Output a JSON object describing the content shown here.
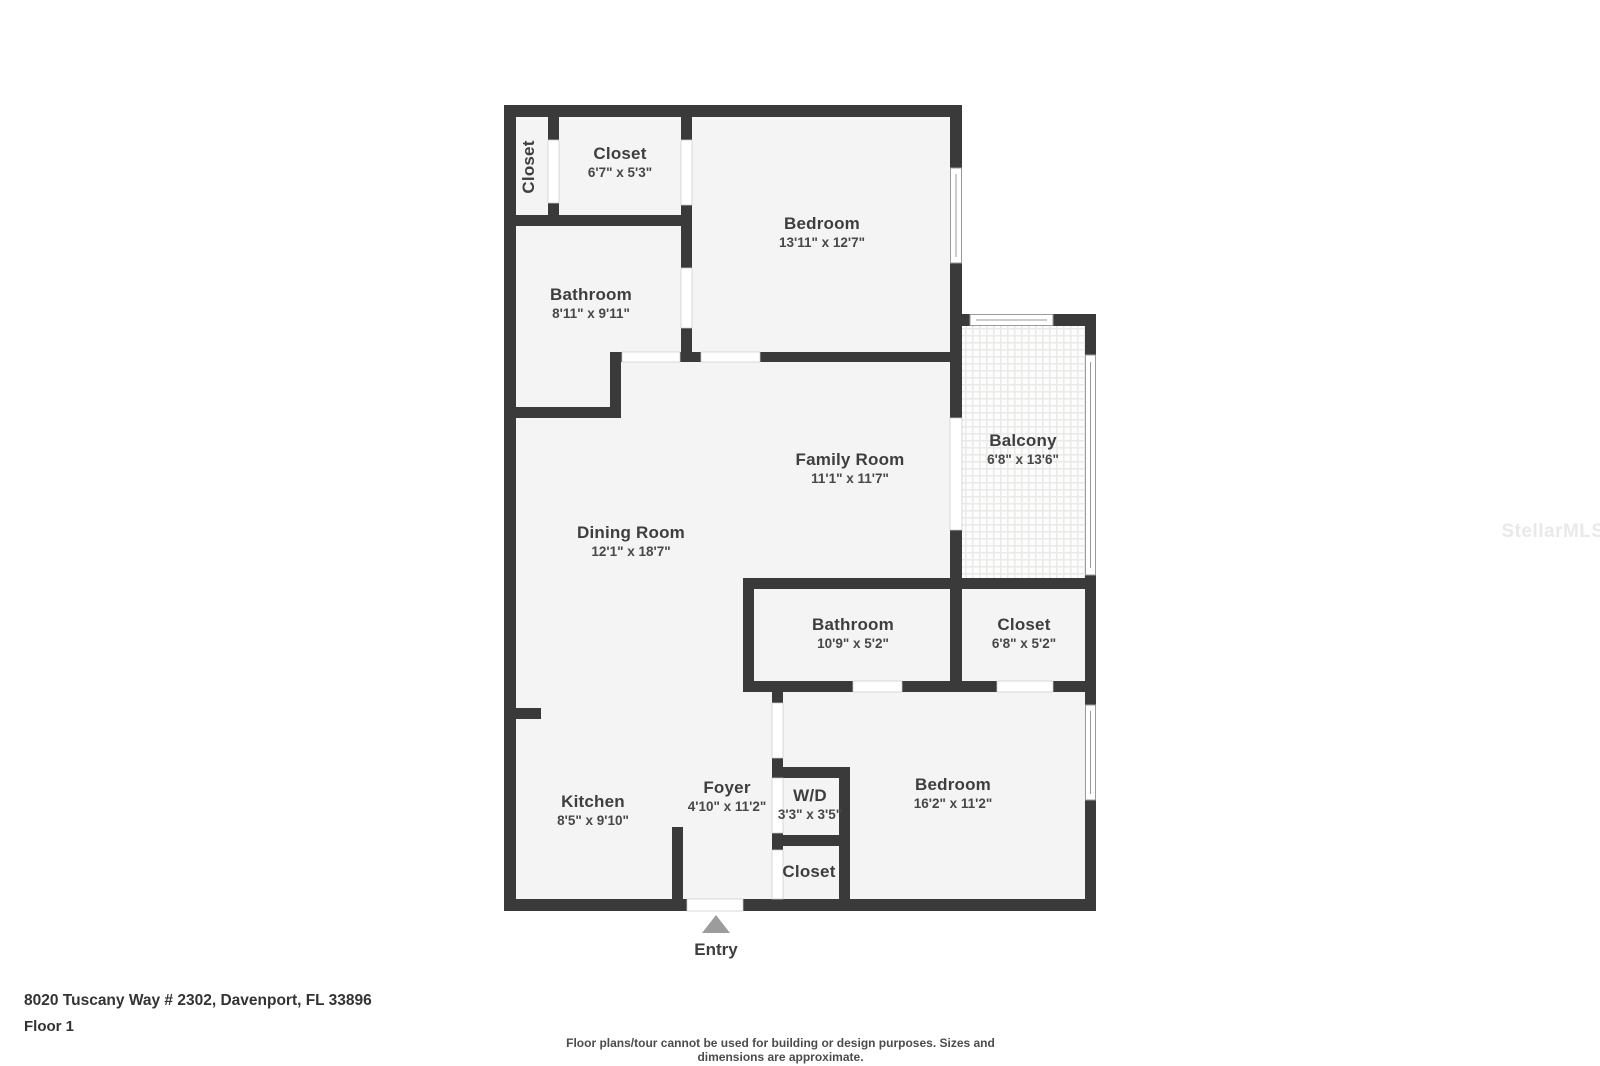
{
  "rooms": [
    {
      "id": "closet-vertical",
      "name": "Closet",
      "dims": ""
    },
    {
      "id": "closet-master",
      "name": "Closet",
      "dims": "6'7\" x 5'3\""
    },
    {
      "id": "bedroom-master",
      "name": "Bedroom",
      "dims": "13'11\" x 12'7\""
    },
    {
      "id": "bathroom-master",
      "name": "Bathroom",
      "dims": "8'11\" x 9'11\""
    },
    {
      "id": "family-room",
      "name": "Family Room",
      "dims": "11'1\" x 11'7\""
    },
    {
      "id": "balcony",
      "name": "Balcony",
      "dims": "6'8\" x 13'6\""
    },
    {
      "id": "dining-room",
      "name": "Dining Room",
      "dims": "12'1\" x 18'7\""
    },
    {
      "id": "bathroom-second",
      "name": "Bathroom",
      "dims": "10'9\" x 5'2\""
    },
    {
      "id": "closet-second",
      "name": "Closet",
      "dims": "6'8\" x 5'2\""
    },
    {
      "id": "kitchen",
      "name": "Kitchen",
      "dims": "8'5\" x 9'10\""
    },
    {
      "id": "foyer",
      "name": "Foyer",
      "dims": "4'10\" x 11'2\""
    },
    {
      "id": "wd",
      "name": "W/D",
      "dims": "3'3\" x 3'5\""
    },
    {
      "id": "bedroom-second",
      "name": "Bedroom",
      "dims": "16'2\" x 11'2\""
    },
    {
      "id": "closet-entry",
      "name": "Closet",
      "dims": ""
    }
  ],
  "entry_label": "Entry",
  "watermark": "StellarMLS",
  "footer": {
    "address": "8020 Tuscany Way # 2302, Davenport, FL 33896",
    "floor": "Floor 1",
    "disclaimer": "Floor plans/tour cannot be used for building or design purposes. Sizes and dimensions are approximate."
  },
  "colors": {
    "wall": "#3a3a3a",
    "floor": "#f4f4f4",
    "door_gap": "#ffffff",
    "window_line": "#9a9a9a",
    "entry_arrow": "#9c9c9c",
    "label_text": "#3e3e3e"
  }
}
